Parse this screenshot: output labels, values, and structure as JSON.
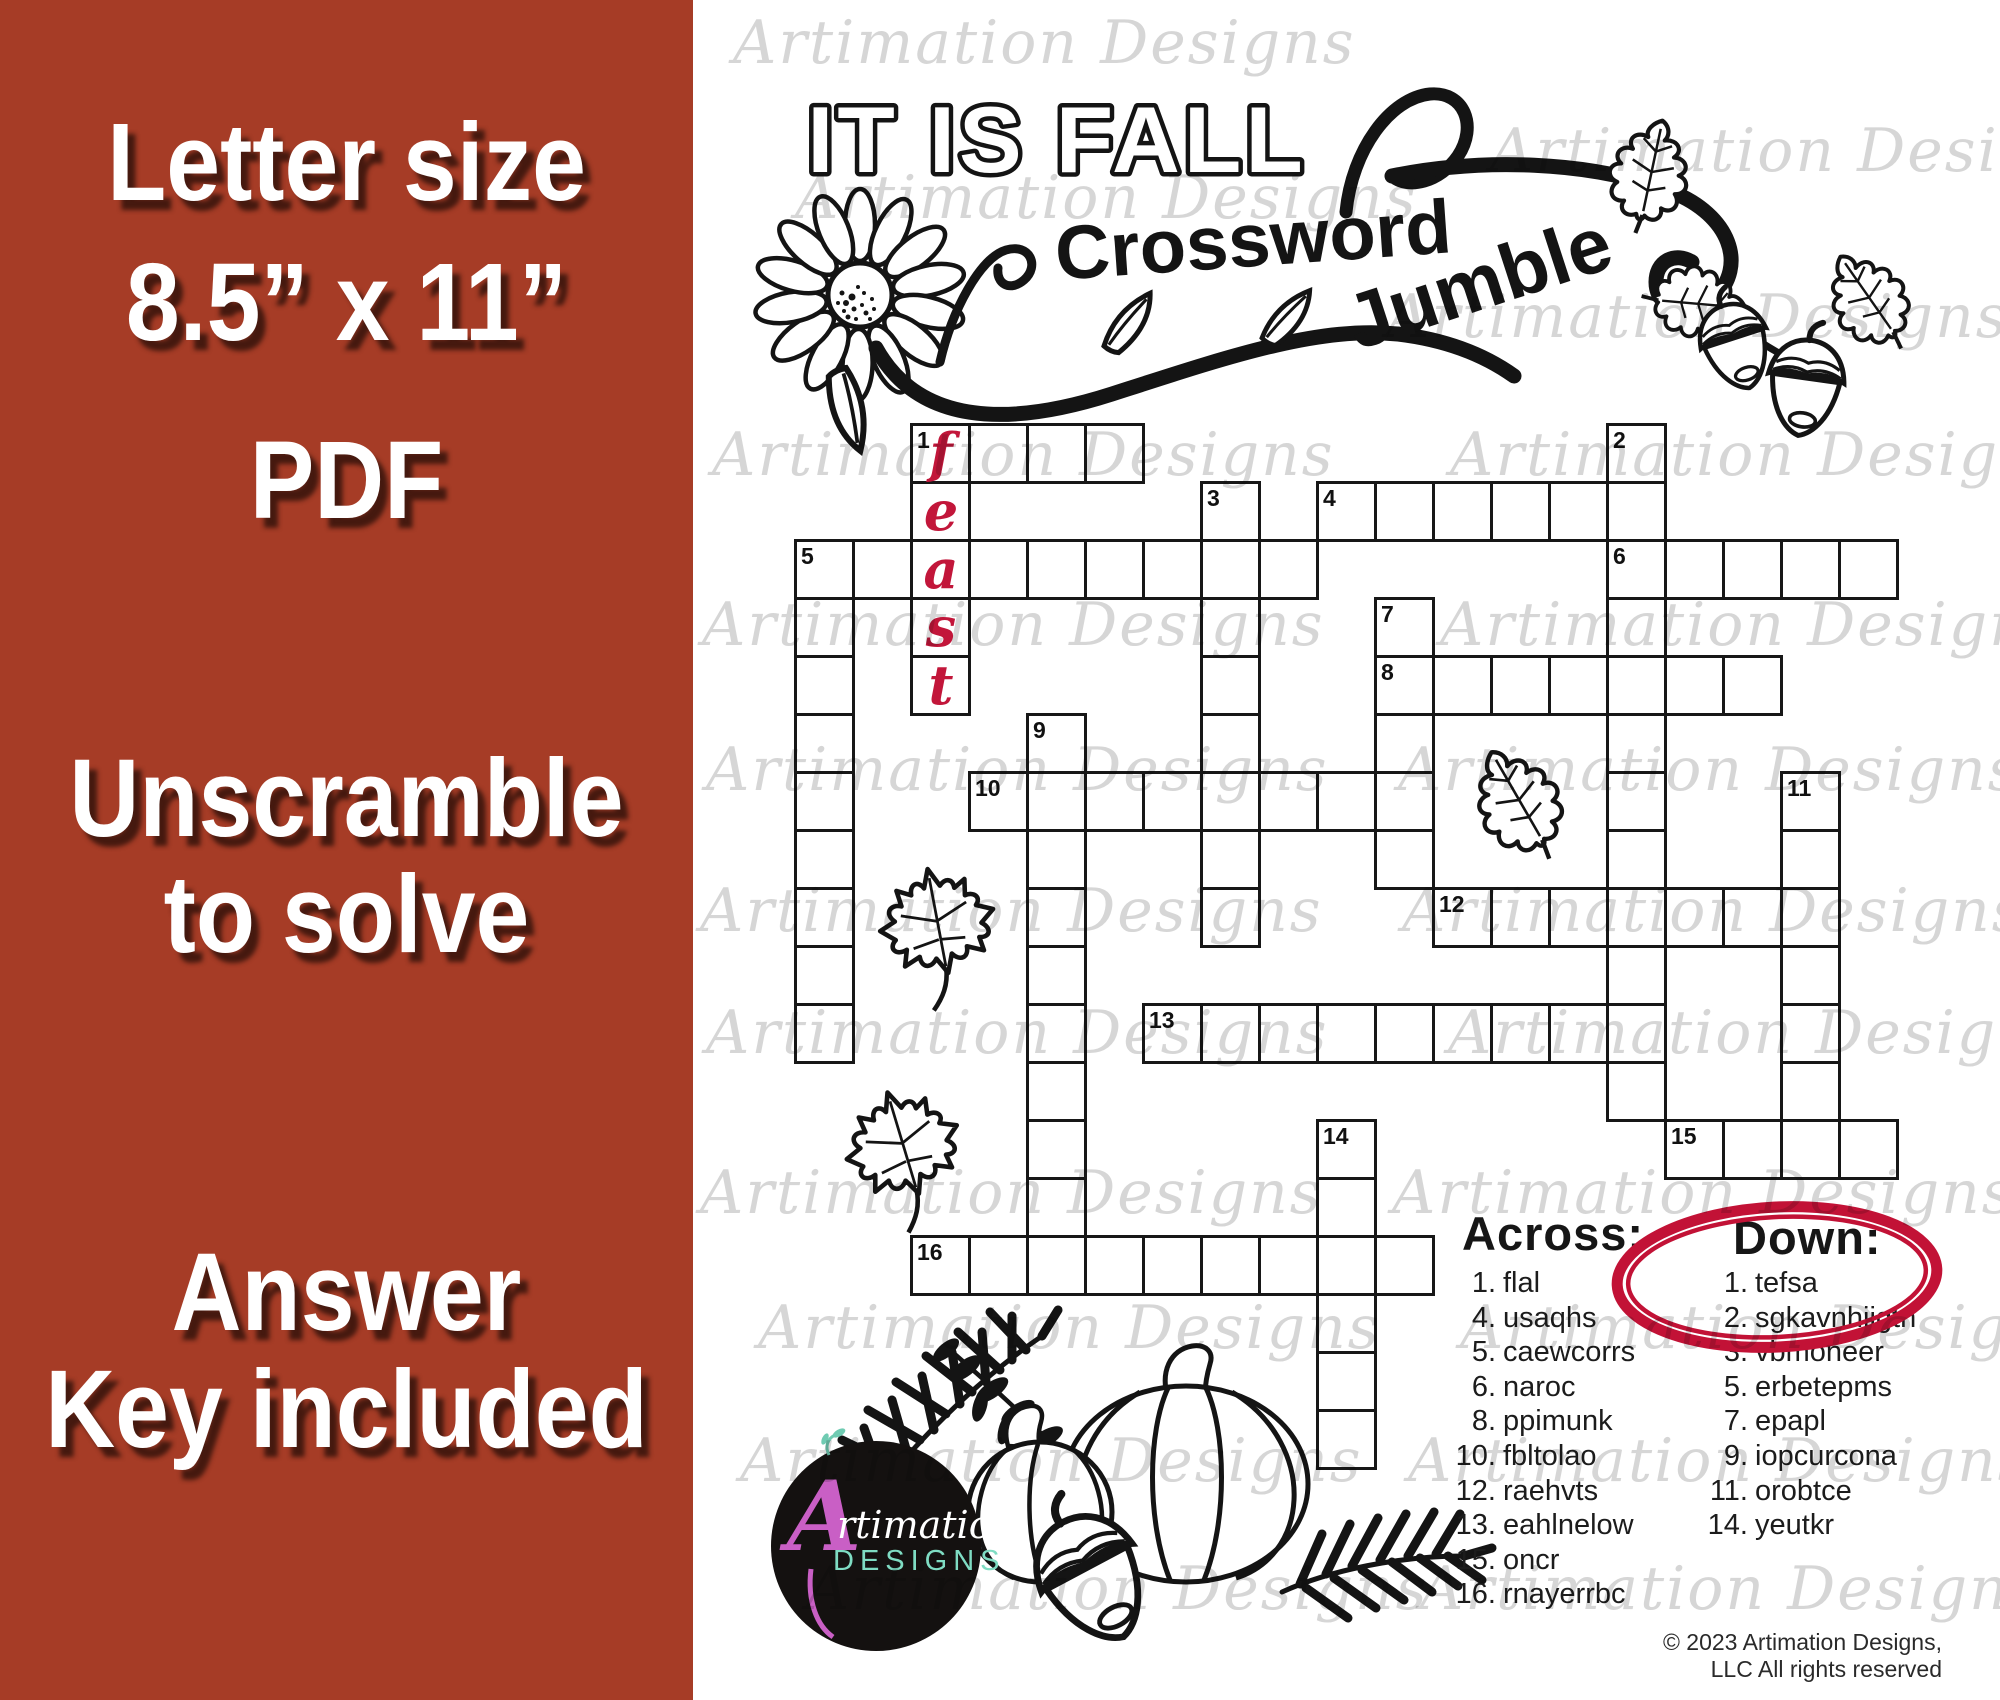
{
  "sidebar": {
    "bg_color": "#a63c26",
    "lines": [
      "Letter size",
      "8.5” x 11”",
      "PDF",
      "Unscramble",
      "to solve",
      "Answer",
      "Key included"
    ]
  },
  "title": {
    "main": "IT IS FALL",
    "sub1": "Crossword",
    "sub2": "Jumble"
  },
  "watermark": {
    "text": "Artimation Designs",
    "color": "#d6d6d6",
    "positions": [
      [
        733,
        8
      ],
      [
        1490,
        116
      ],
      [
        795,
        163
      ],
      [
        1386,
        282
      ],
      [
        712,
        420
      ],
      [
        1450,
        420
      ],
      [
        702,
        590
      ],
      [
        1440,
        590
      ],
      [
        706,
        735
      ],
      [
        1398,
        735
      ],
      [
        700,
        876
      ],
      [
        1402,
        876
      ],
      [
        706,
        998
      ],
      [
        1448,
        998
      ],
      [
        700,
        1158
      ],
      [
        1392,
        1158
      ],
      [
        758,
        1293
      ],
      [
        1460,
        1293
      ],
      [
        740,
        1426
      ],
      [
        1408,
        1426
      ],
      [
        806,
        1554
      ],
      [
        1420,
        1554
      ]
    ]
  },
  "grid": {
    "cell_size": 58,
    "filled_word": "feast",
    "filled_color": "#c2163a",
    "entries": [
      {
        "num": "1",
        "x": 910,
        "y": 423,
        "dir": "across",
        "len": 4
      },
      {
        "num": "",
        "x": 910,
        "y": 423,
        "dir": "down",
        "len": 5,
        "letters": [
          "f",
          "e",
          "a",
          "s",
          "t"
        ]
      },
      {
        "num": "2",
        "x": 1606,
        "y": 423,
        "dir": "down",
        "len": 12
      },
      {
        "num": "3",
        "x": 1200,
        "y": 481,
        "dir": "down",
        "len": 8
      },
      {
        "num": "4",
        "x": 1316,
        "y": 481,
        "dir": "across",
        "len": 6
      },
      {
        "num": "5",
        "x": 794,
        "y": 539,
        "dir": "across",
        "len": 9
      },
      {
        "num": "",
        "x": 794,
        "y": 539,
        "dir": "down",
        "len": 9
      },
      {
        "num": "6",
        "x": 1606,
        "y": 539,
        "dir": "across",
        "len": 5
      },
      {
        "num": "7",
        "x": 1374,
        "y": 597,
        "dir": "down",
        "len": 5
      },
      {
        "num": "8",
        "x": 1374,
        "y": 655,
        "dir": "across",
        "len": 7
      },
      {
        "num": "9",
        "x": 1026,
        "y": 713,
        "dir": "down",
        "len": 10
      },
      {
        "num": "10",
        "x": 968,
        "y": 771,
        "dir": "across",
        "len": 8
      },
      {
        "num": "11",
        "x": 1780,
        "y": 771,
        "dir": "down",
        "len": 7
      },
      {
        "num": "12",
        "x": 1432,
        "y": 887,
        "dir": "across",
        "len": 7
      },
      {
        "num": "13",
        "x": 1142,
        "y": 1003,
        "dir": "across",
        "len": 9
      },
      {
        "num": "14",
        "x": 1316,
        "y": 1119,
        "dir": "down",
        "len": 6
      },
      {
        "num": "15",
        "x": 1664,
        "y": 1119,
        "dir": "across",
        "len": 4
      },
      {
        "num": "16",
        "x": 910,
        "y": 1235,
        "dir": "across",
        "len": 9
      }
    ]
  },
  "clues": {
    "across_heading": "Across:",
    "down_heading": "Down:",
    "across": [
      [
        "1.",
        "flal"
      ],
      [
        "4.",
        "usaqhs"
      ],
      [
        "5.",
        "caewcorrs"
      ],
      [
        "6.",
        "naroc"
      ],
      [
        "8.",
        "ppimunk"
      ],
      [
        "10.",
        "fbltolao"
      ],
      [
        "12.",
        "raehvts"
      ],
      [
        "13.",
        "eahlnelow"
      ],
      [
        "15.",
        "oncr"
      ],
      [
        "16.",
        "rnayerrbc"
      ]
    ],
    "down": [
      [
        "1.",
        "tefsa"
      ],
      [
        "2.",
        "sgkavnhiigtn"
      ],
      [
        "3.",
        "vbmoneer"
      ],
      [
        "5.",
        "erbetepms"
      ],
      [
        "7.",
        "epapl"
      ],
      [
        "9.",
        "iopcurcona"
      ],
      [
        "11.",
        "orobtce"
      ],
      [
        "14.",
        "yeutkr"
      ]
    ]
  },
  "highlight_circle": {
    "color": "#c21236"
  },
  "logo": {
    "name_initial": "A",
    "name_script": "rtimation",
    "subtitle": "DESIGNS",
    "initial_color": "#c95fc5",
    "subtitle_color": "#7fdcc3"
  },
  "footer": {
    "copyright": "© 2023 Artimation Designs, LLC  All rights reserved"
  }
}
